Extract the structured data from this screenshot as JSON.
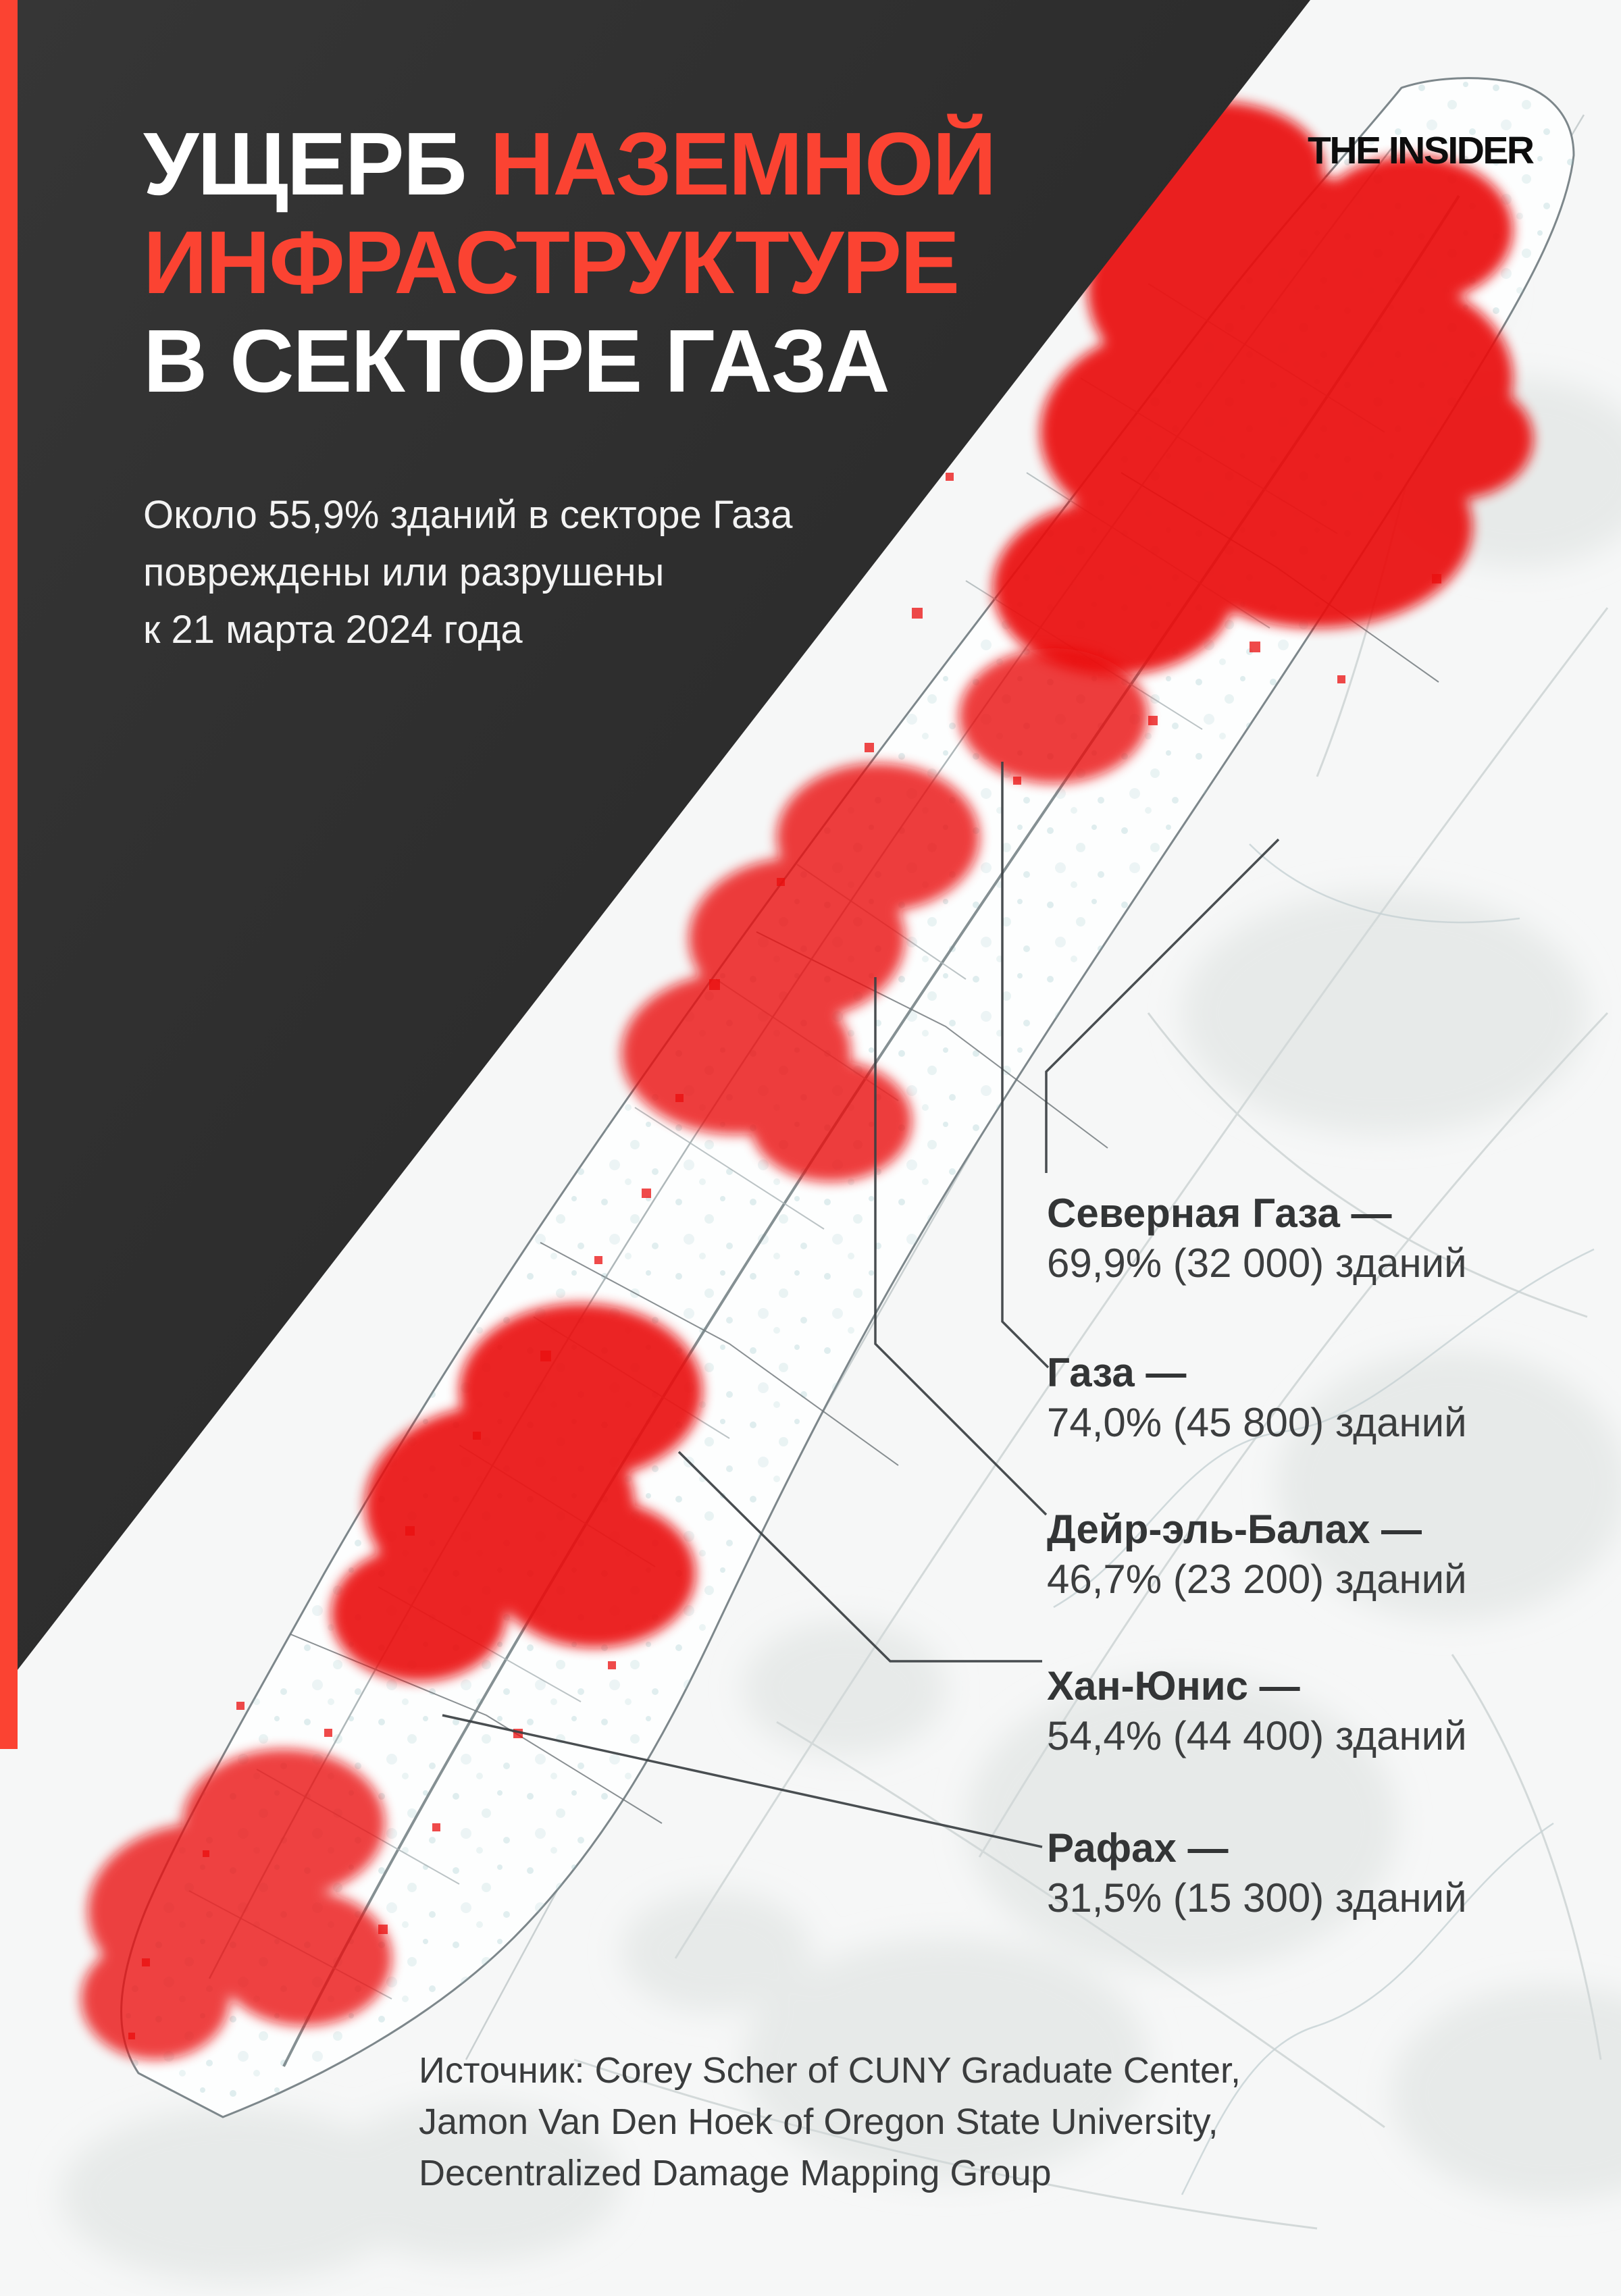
{
  "accent_color": "#fb4332",
  "panel_color": "#2d2d2d",
  "damage_color": "#e90f0f",
  "brand": {
    "logo_text": "THE INSIDER"
  },
  "header": {
    "title_white_1": "УЩЕРБ",
    "title_red_1": "НАЗЕМНОЙ",
    "title_red_2": "ИНФРАСТРУКТУРЕ",
    "title_white_2": "В СЕКТОРЕ ГАЗА",
    "subtitle": "Около 55,9% зданий в секторе Газа\nповреждены или разрушены\nк 21 марта 2024 года"
  },
  "map": {
    "labels": [
      {
        "name": "Северная Газа —",
        "stat": "69,9% (32 000) зданий"
      },
      {
        "name": "Газа —",
        "stat": "74,0% (45 800) зданий"
      },
      {
        "name": "Дейр-эль-Балах —",
        "stat": "46,7% (23 200) зданий"
      },
      {
        "name": "Хан-Юнис —",
        "stat": "54,4% (44 400) зданий"
      },
      {
        "name": "Рафах —",
        "stat": "31,5% (15 300) зданий"
      }
    ]
  },
  "source": {
    "text": "Источник: Corey Scher of CUNY Graduate Center,\nJamon Van Den Hoek of Oregon State University,\nDecentralized Damage Mapping Group"
  },
  "chart_data": {
    "type": "map",
    "title": "Ущерб наземной инфраструктуре в секторе Газа",
    "total_damaged_share_pct": 55.9,
    "as_of_date_shown": "21 марта 2024",
    "regions": [
      {
        "name": "Северная Газа",
        "damaged_pct": 69.9,
        "buildings_damaged": 32000
      },
      {
        "name": "Газа",
        "damaged_pct": 74.0,
        "buildings_damaged": 45800
      },
      {
        "name": "Дейр-эль-Балах",
        "damaged_pct": 46.7,
        "buildings_damaged": 23200
      },
      {
        "name": "Хан-Юнис",
        "damaged_pct": 54.4,
        "buildings_damaged": 44400
      },
      {
        "name": "Рафах",
        "damaged_pct": 31.5,
        "buildings_damaged": 15300
      }
    ]
  }
}
